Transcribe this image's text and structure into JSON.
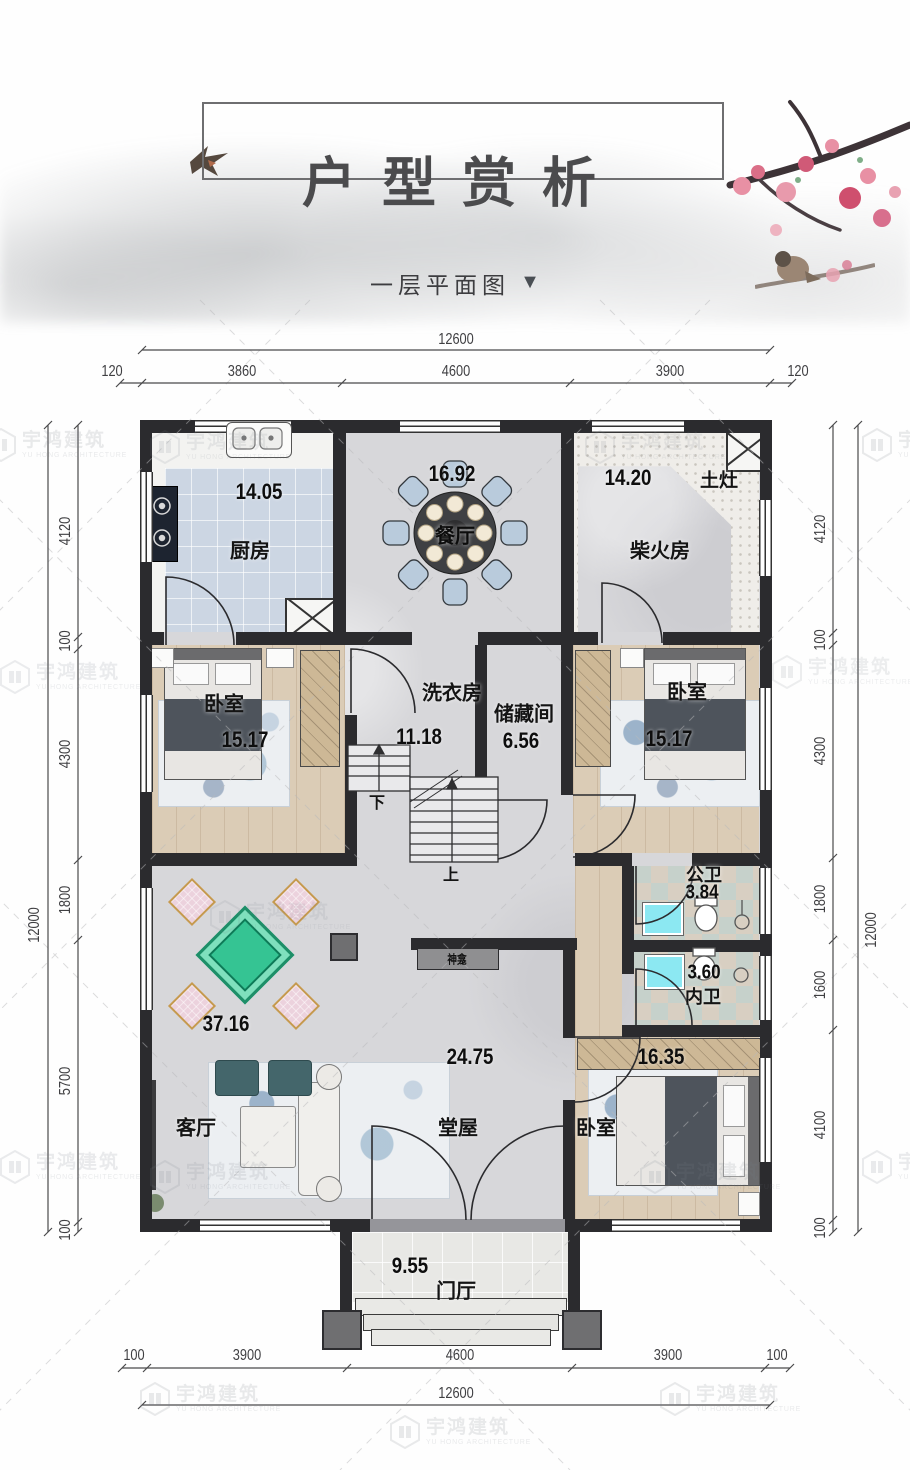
{
  "header": {
    "title": "户型赏析",
    "subtitle": "一层平面图",
    "arrow": "▼"
  },
  "watermark": {
    "name": "宇鸿建筑",
    "sub": "YU HONG ARCHITECTURE"
  },
  "dims": {
    "top": {
      "total": "12600",
      "s0": "120",
      "s1": "3860",
      "s2": "4600",
      "s3": "3900",
      "s4": "120"
    },
    "bottom": {
      "total": "12600",
      "s0": "100",
      "s1": "3900",
      "s2": "4600",
      "s3": "3900",
      "s4": "100"
    },
    "left": {
      "total": "12000",
      "s0": "4120",
      "s1": "100",
      "s2": "4300",
      "s3": "1800",
      "s4": "5700",
      "s5": "100"
    },
    "right": {
      "total": "12000",
      "s0": "4120",
      "s1": "100",
      "s2": "4300",
      "s3": "1800",
      "s4": "1600",
      "s5": "4100",
      "s6": "100"
    }
  },
  "rooms": {
    "kitchen": {
      "name": "厨房",
      "area": "14.05"
    },
    "dining": {
      "name": "餐厅",
      "area": "16.92"
    },
    "firewood": {
      "name": "柴火房",
      "area": "14.20",
      "stove": "土灶"
    },
    "bedroom_left": {
      "name": "卧室",
      "area": "15.17"
    },
    "laundry": {
      "name": "洗衣房",
      "area": "11.18"
    },
    "storage": {
      "name": "储藏间",
      "area": "6.56"
    },
    "bedroom_right": {
      "name": "卧室",
      "area": "15.17"
    },
    "bath_public": {
      "name": "公卫",
      "area": "3.84"
    },
    "bath_private": {
      "name": "内卫",
      "area": "3.60"
    },
    "living": {
      "name": "客厅",
      "area": "37.16"
    },
    "hall": {
      "name": "堂屋",
      "area": "24.75"
    },
    "bedroom_bottom": {
      "name": "卧室",
      "area": "16.35"
    },
    "porch": {
      "name": "门厅",
      "area": "9.55"
    },
    "shrine": {
      "name": "神龛"
    }
  },
  "stairs": {
    "down": "下",
    "up": "上"
  },
  "colors": {
    "wall": "#2b2b2e",
    "mahjong_green": "#35c493",
    "dining_chair": "#b9cbdc",
    "sink_cyan": "#8ce8f2"
  }
}
